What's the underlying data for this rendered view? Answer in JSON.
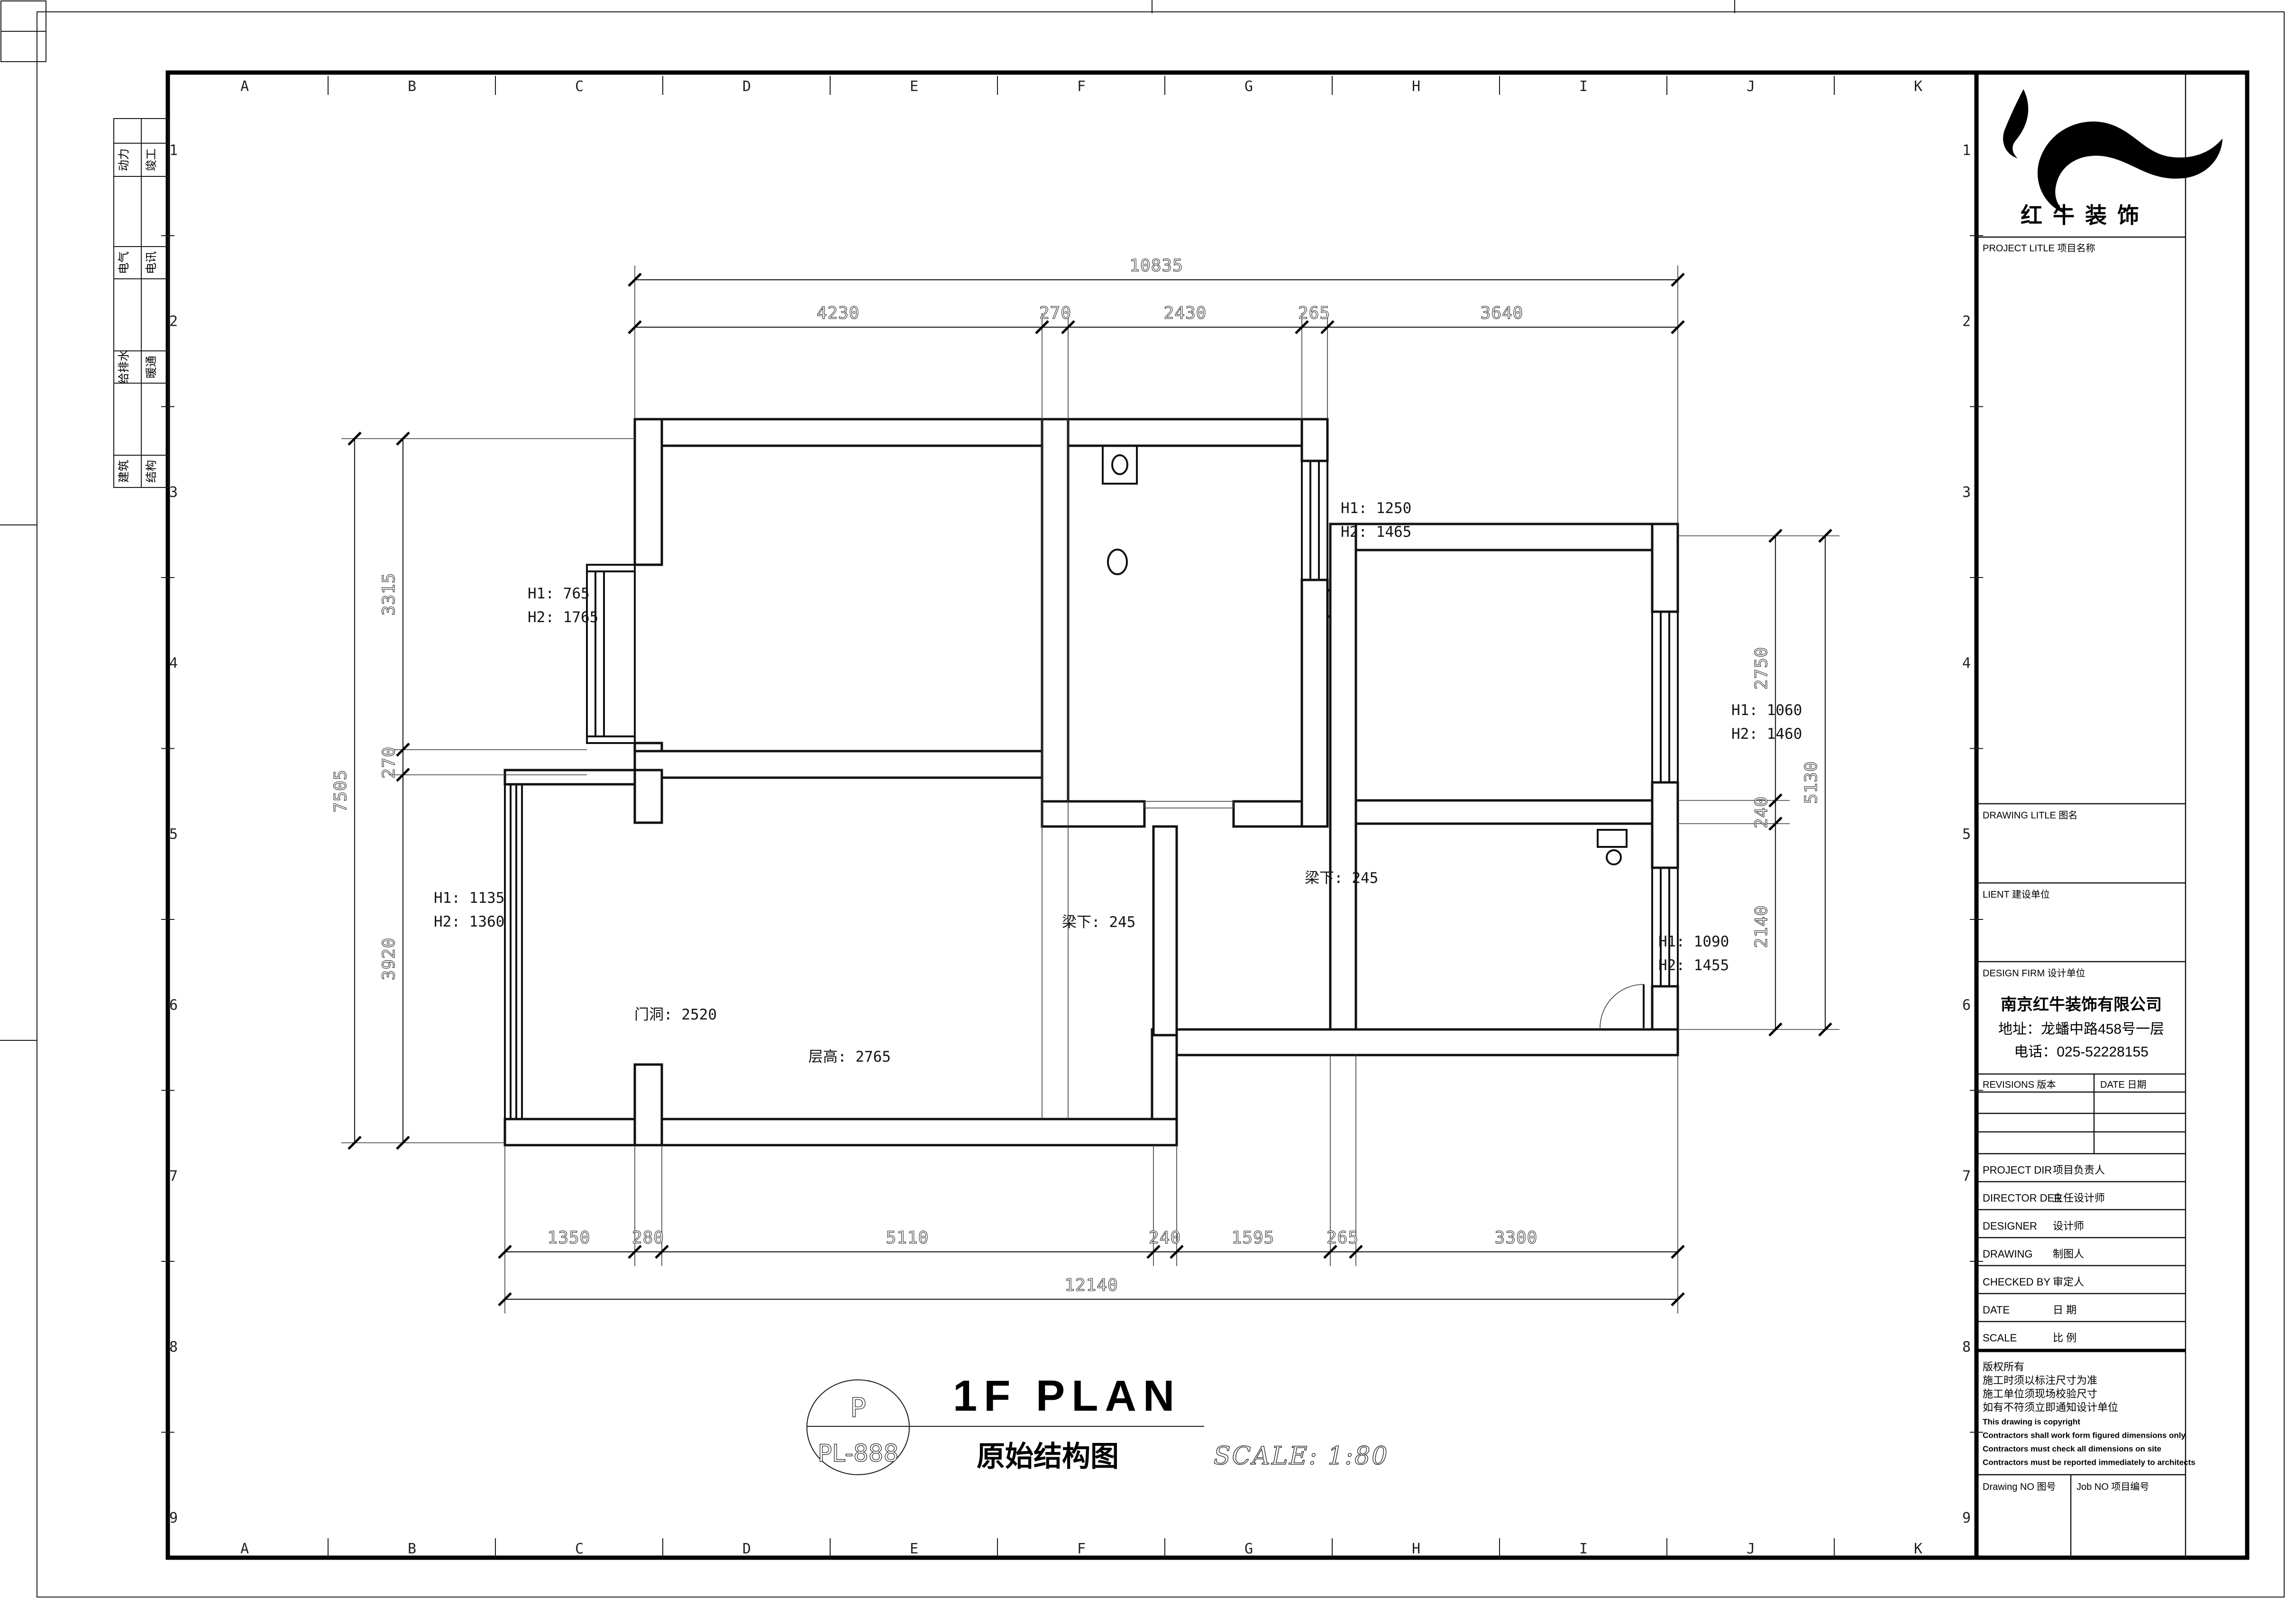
{
  "frame": {
    "grid_letters": [
      "A",
      "B",
      "C",
      "D",
      "E",
      "F",
      "G",
      "H",
      "I",
      "J",
      "K"
    ],
    "grid_numbers": [
      "1",
      "2",
      "3",
      "4",
      "5",
      "6",
      "7",
      "8",
      "9"
    ]
  },
  "sidebar": {
    "rows": [
      {
        "left": "动力",
        "right": "竣工"
      },
      {
        "left": "电气",
        "right": "电讯"
      },
      {
        "left": "给排水",
        "right": "暖通"
      },
      {
        "left": "建筑",
        "right": "结构"
      }
    ]
  },
  "title_block": {
    "brand": "红牛装饰",
    "project_title_label": "PROJECT LITLE  项目名称",
    "drawing_title_label": "DRAWING LITLE  图名",
    "client_label": "LIENT  建设单位",
    "design_firm_label": "DESIGN FIRM  设计单位",
    "company_name": "南京红牛装饰有限公司",
    "company_address": "地址：龙蟠中路458号一层",
    "company_phone": "电话：025-52228155",
    "revisions_label": "REVISIONS  版本",
    "date_col_label": "DATE  日期",
    "rows": [
      {
        "en": "PROJECT DIR",
        "cn": "项目负责人"
      },
      {
        "en": "DIRECTOR DER",
        "cn": "主任设计师"
      },
      {
        "en": "DESIGNER",
        "cn": "设计师"
      },
      {
        "en": "DRAWING",
        "cn": "制图人"
      },
      {
        "en": "CHECKED BY",
        "cn": "审定人"
      },
      {
        "en": "DATE",
        "cn": "日  期"
      },
      {
        "en": "SCALE",
        "cn": "比  例"
      }
    ],
    "copyright_lines": [
      "版权所有",
      "施工时须以标注尺寸为准",
      "施工单位须现场校验尺寸",
      "如有不符须立即通知设计单位",
      "This drawing is copyright",
      "Contractors shall work form figured dimensions only",
      "Contractors must check all dimensions on site",
      "Contractors must be reported immediately to architects"
    ],
    "drawing_no_label": "Drawing NO  图号",
    "job_no_label": "Job NO  项目编号"
  },
  "plan": {
    "dims": {
      "top": {
        "overall": "10835",
        "segments": [
          "4230",
          "270",
          "2430",
          "265",
          "3640"
        ]
      },
      "bottom": {
        "overall": "12140",
        "segments": [
          "1350",
          "280",
          "5110",
          "240",
          "1595",
          "265",
          "3300"
        ]
      },
      "left": {
        "overall": "7505",
        "segments": [
          "3315",
          "270",
          "3920"
        ]
      },
      "right": {
        "overall": "5130",
        "segments": [
          "2750",
          "240",
          "2140"
        ]
      }
    },
    "window_labels": [
      {
        "line1": "H1: 765",
        "line2": "H2: 1765"
      },
      {
        "line1": "H1: 1250",
        "line2": "H2: 1465"
      },
      {
        "line1": "H1: 1060",
        "line2": "H2: 1460"
      },
      {
        "line1": "H1: 1090",
        "line2": "H2: 1455"
      },
      {
        "line1": "H1: 1135",
        "line2": "H2: 1360"
      }
    ],
    "notes": [
      "门洞: 2520",
      "层高: 2765",
      "梁下: 245",
      "梁下: 245"
    ]
  },
  "title": {
    "bubble_top": "P",
    "bubble_bottom": "PL-888",
    "main": "1F PLAN",
    "sub": "原始结构图",
    "scale": "SCALE: 1:80"
  }
}
